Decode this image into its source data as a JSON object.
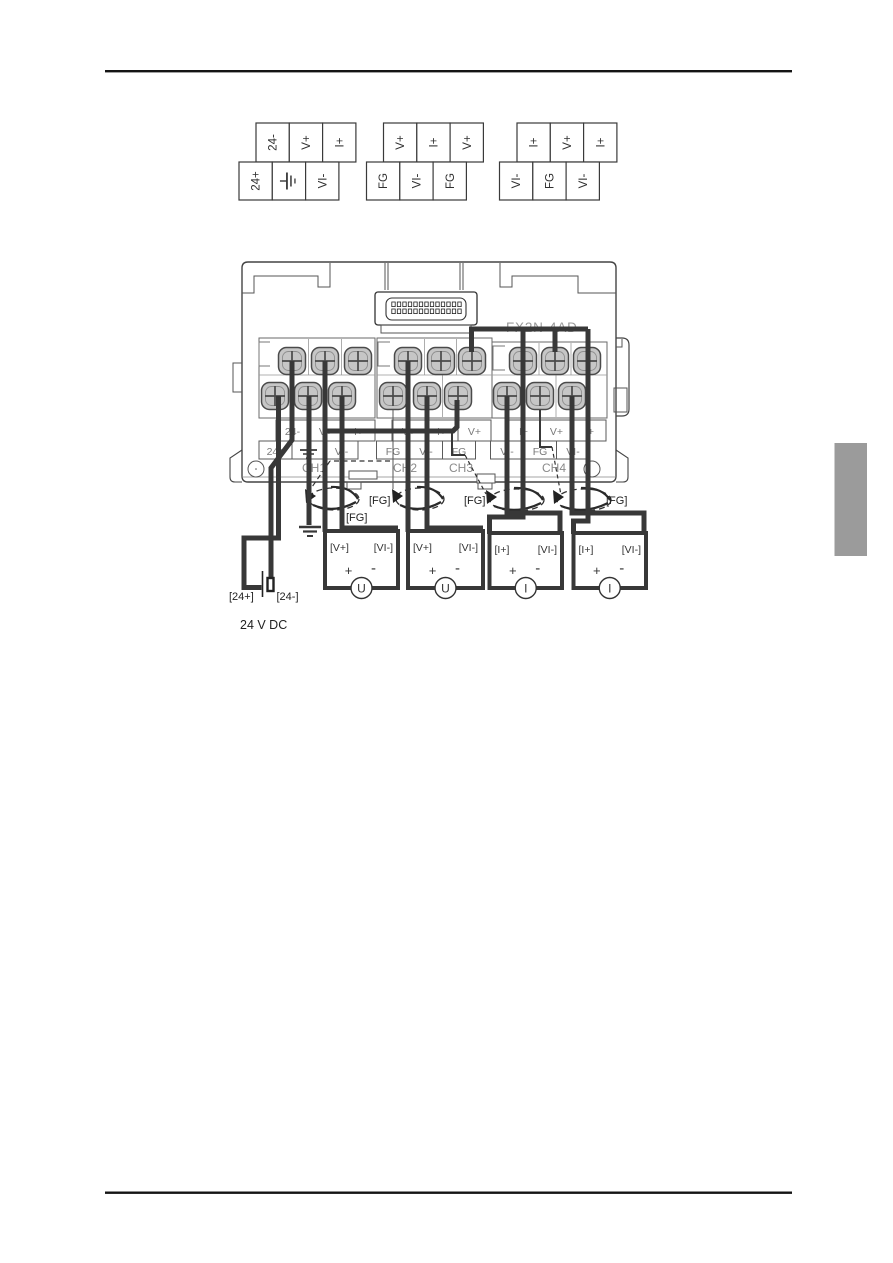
{
  "page": {
    "background": "#ffffff"
  },
  "header": {
    "rule": true
  },
  "footer": {
    "rule": true
  },
  "side_tab": {
    "color": "#9b9b9b"
  },
  "icons": {
    "earth_ground": "earth-ground-icon",
    "shield_twist": "shielded-twisted-pair-icon",
    "battery": "battery-icon",
    "screw": "terminal-screw-icon"
  },
  "colors": {
    "wire": "#383838",
    "screw_fill": "#c6c6c6",
    "screw_stroke": "#4a4a4a",
    "case_stroke": "#444444",
    "label_text": "#7a7a7a",
    "gray_text": "#8a8a8a",
    "dark_text": "#222222",
    "tab": "#9b9b9b"
  },
  "ref_tables": [
    {
      "top": [
        "24-",
        "V+",
        "I+"
      ],
      "bottom": [
        "24+",
        null,
        "VI-"
      ]
    },
    {
      "top": [
        "V+",
        "I+",
        "V+"
      ],
      "bottom": [
        "FG",
        "VI-",
        "FG"
      ]
    },
    {
      "top": [
        "I+",
        "V+",
        "I+"
      ],
      "bottom": [
        "VI-",
        "FG",
        "VI-"
      ]
    }
  ],
  "module": {
    "model": "FX2N-4AD",
    "row1_labels": [
      "24-",
      "V+",
      "I+",
      "V+",
      "I+",
      "V+",
      "I+",
      "V+",
      "I+"
    ],
    "row2_labels": [
      "24+",
      null,
      "VI-",
      "FG",
      "VI-",
      "FG",
      "VI-",
      "FG",
      "VI-"
    ],
    "channels": [
      "CH1",
      "CH2",
      "CH3",
      "CH4"
    ]
  },
  "annotations": {
    "fg_labels": [
      "[FG]",
      "[FG]",
      "[FG]",
      "[FG]"
    ]
  },
  "sources": [
    {
      "pos": "[V+]",
      "neg": "[VI-]",
      "plus": "+",
      "minus": "-",
      "meter": "U"
    },
    {
      "pos": "[V+]",
      "neg": "[VI-]",
      "plus": "+",
      "minus": "-",
      "meter": "U"
    },
    {
      "pos": "[I+]",
      "neg": "[VI-]",
      "plus": "+",
      "minus": "-",
      "meter": "I"
    },
    {
      "pos": "[I+]",
      "neg": "[VI-]",
      "plus": "+",
      "minus": "-",
      "meter": "I"
    }
  ],
  "battery": {
    "positive": "[24+]",
    "negative": "[24-]",
    "caption": "24 V DC"
  }
}
